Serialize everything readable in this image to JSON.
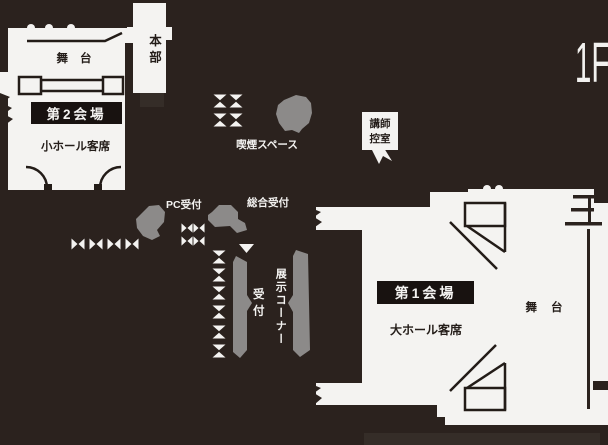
{
  "floor": {
    "label": "1F"
  },
  "venue2": {
    "name": "第2会場",
    "stage_label": "舞台",
    "seating_label": "小ホール客席"
  },
  "headquarters": {
    "label": "本部"
  },
  "smoking_area": {
    "label": "喫煙スペース"
  },
  "lecturer_room": {
    "lines": [
      "講師",
      "控室"
    ]
  },
  "pc_reception": {
    "label": "PC受付"
  },
  "general_reception": {
    "label": "総合受付"
  },
  "reception_desk": {
    "label": "受付"
  },
  "exhibition_corner": {
    "label": "展示コーナー"
  },
  "venue1": {
    "name": "第1会場",
    "stage_label": "舞台",
    "seating_label": "大ホール客席"
  },
  "icons": {
    "table": "paired-seats-table",
    "plant": "foliage-blob",
    "door": "door-swing-arc",
    "wall_break": "zigzag-wall-break",
    "pointer": "room-pointer-arrow"
  },
  "colors": {
    "background": "#2b221e",
    "room_fill": "#f4f3f1",
    "wall_line": "#231c18",
    "sign_box": "#181210",
    "furniture_gray": "#8c8a89",
    "shadow": "#352d28",
    "text_dark": "#241d19",
    "text_light": "#f4f3f1"
  }
}
